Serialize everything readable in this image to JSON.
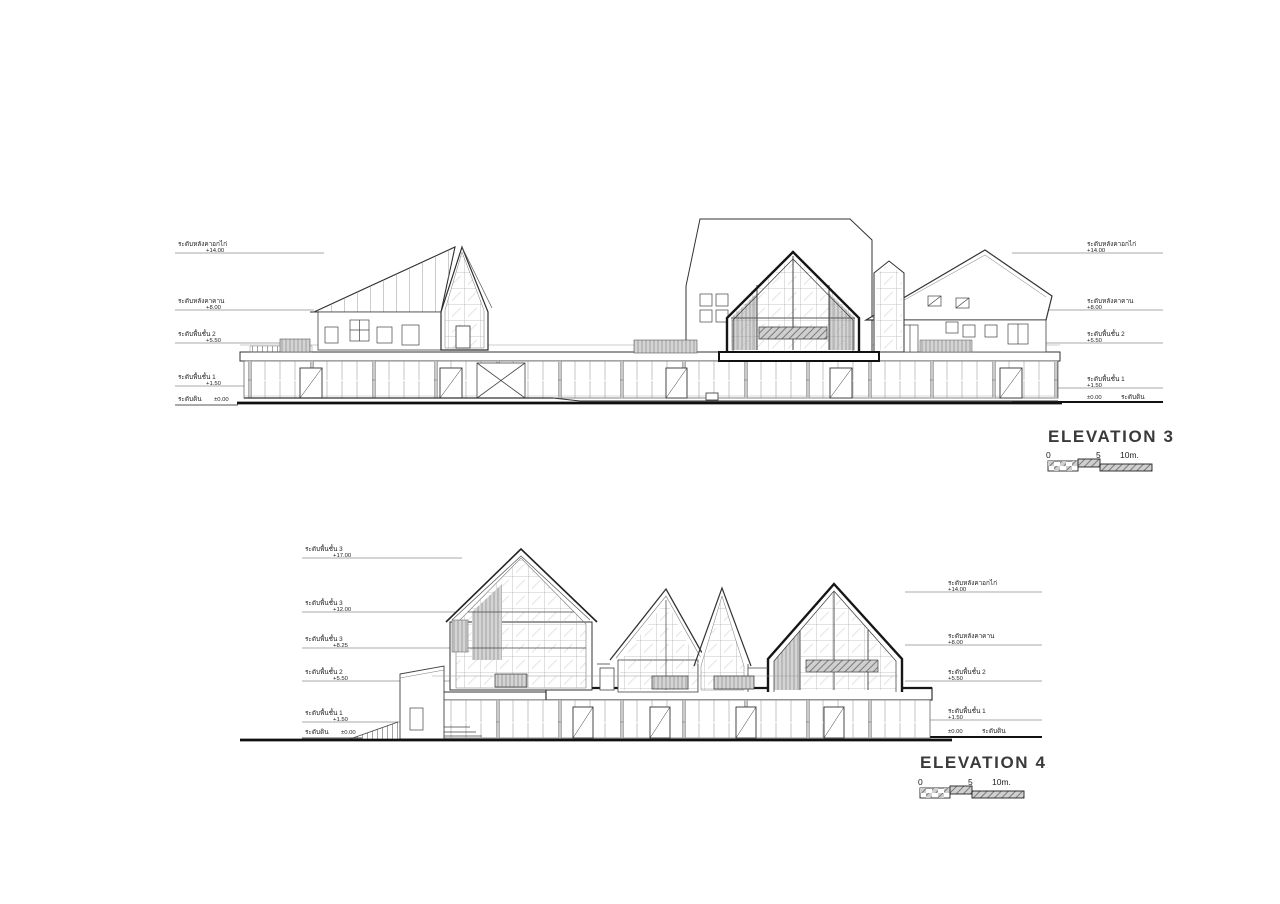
{
  "palette": {
    "ink": "#222222",
    "light_line": "#8f8f8f",
    "shade_gray": "#d4d4d4",
    "paper": "#ffffff"
  },
  "elevation3": {
    "title": "ELEVATION 3",
    "scale_bar": {
      "start": "0",
      "mid": "5",
      "end": "10m."
    },
    "levels_left": [
      {
        "label": "ระดับหลังคาอกไก่",
        "value": "+14.00"
      },
      {
        "label": "ระดับหลังคาคาน",
        "value": "+8.00"
      },
      {
        "label": "ระดับพื้นชั้น 2",
        "value": "+5.50"
      },
      {
        "label": "ระดับพื้นชั้น 1",
        "value": "+1.50"
      }
    ],
    "ground_left": {
      "label": "ระดับดิน",
      "value": "±0.00"
    },
    "levels_right": [
      {
        "label": "ระดับหลังคาอกไก่",
        "value": "+14.00"
      },
      {
        "label": "ระดับหลังคาคาน",
        "value": "+8.00"
      },
      {
        "label": "ระดับพื้นชั้น 2",
        "value": "+5.50"
      },
      {
        "label": "ระดับพื้นชั้น 1",
        "value": "+1.50"
      }
    ],
    "ground_right": {
      "value": "±0.00",
      "label": "ระดับดิน"
    }
  },
  "elevation4": {
    "title": "ELEVATION 4",
    "scale_bar": {
      "start": "0",
      "mid": "5",
      "end": "10m."
    },
    "levels_left": [
      {
        "label": "ระดับพื้นชั้น 3",
        "value": "+17.00"
      },
      {
        "label": "ระดับพื้นชั้น 3",
        "value": "+12.00"
      },
      {
        "label": "ระดับพื้นชั้น 3",
        "value": "+8.25"
      },
      {
        "label": "ระดับพื้นชั้น 2",
        "value": "+5.50"
      },
      {
        "label": "ระดับพื้นชั้น 1",
        "value": "+1.50"
      }
    ],
    "ground_left": {
      "label": "ระดับดิน",
      "value": "±0.00"
    },
    "levels_right": [
      {
        "label": "ระดับหลังคาอกไก่",
        "value": "+14.00"
      },
      {
        "label": "ระดับหลังคาคาน",
        "value": "+8.00"
      },
      {
        "label": "ระดับพื้นชั้น 2",
        "value": "+5.50"
      },
      {
        "label": "ระดับพื้นชั้น 1",
        "value": "+1.50"
      }
    ],
    "ground_right": {
      "value": "±0.00",
      "label": "ระดับดิน"
    }
  }
}
